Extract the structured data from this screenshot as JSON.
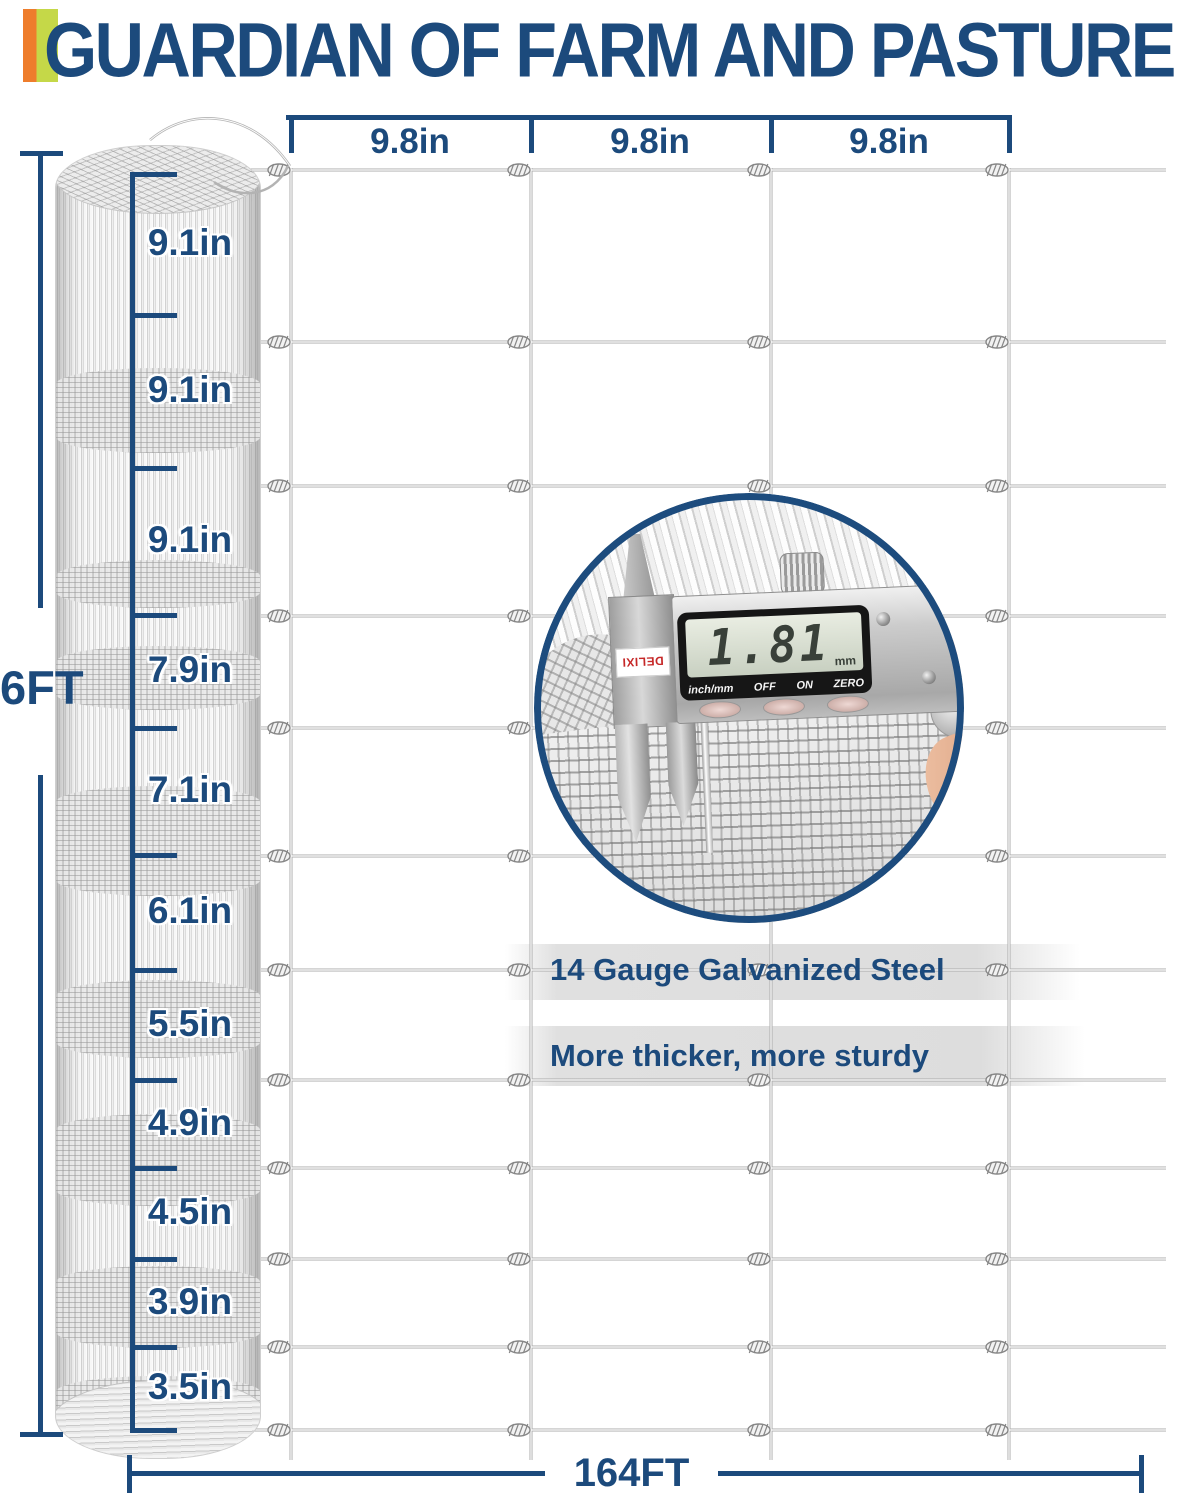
{
  "title": "GUARDIAN OF FARM AND PASTURE",
  "accent_bar": {
    "orange": "#ee7d2c",
    "green": "#c5d848"
  },
  "theme": {
    "navy": "#1c4a7c",
    "wire_gray": "#ababab",
    "lcd_bg": "#d7dfd0"
  },
  "top_dimension": {
    "segments": [
      "9.8in",
      "9.8in",
      "9.8in"
    ]
  },
  "side_dimension": {
    "height": "6FT"
  },
  "bottom_dimension": {
    "length": "164FT"
  },
  "segments": [
    "9.1in",
    "9.1in",
    "9.1in",
    "7.9in",
    "7.1in",
    "6.1in",
    "5.5in",
    "4.9in",
    "4.5in",
    "3.9in",
    "3.5in"
  ],
  "features": [
    "14 Gauge Galvanized Steel",
    "More thicker, more sturdy"
  ],
  "caliper": {
    "brand": "DELIXI",
    "display_value": "1.81",
    "display_unit": "mm",
    "buttons": [
      "inch/mm",
      "OFF",
      "ON",
      "ZERO"
    ]
  }
}
